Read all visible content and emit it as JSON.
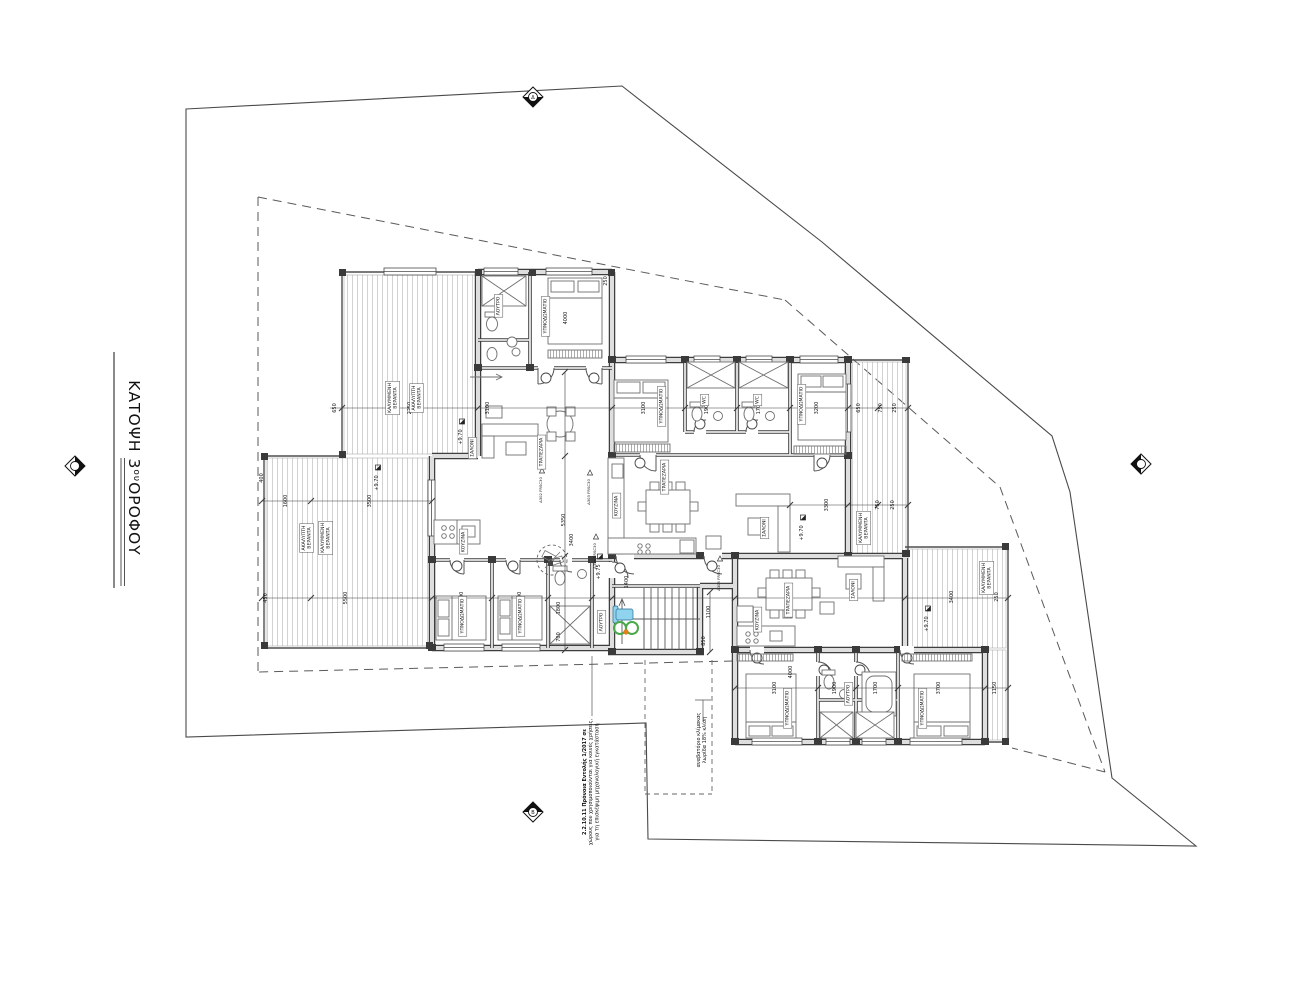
{
  "title": {
    "prefix": "ΚΑΤΟΨΗ 3",
    "superscript": "ου",
    "suffix": "ΟΡΟΦΟΥ"
  },
  "annotations": {
    "room_labels": [
      {
        "lines": [
          "ΥΠΝΟΔΩΜΑΤΙΟ"
        ],
        "x": 545,
        "y": 316
      },
      {
        "lines": [
          "ΛΟΥΤΡΟ"
        ],
        "x": 498,
        "y": 306
      },
      {
        "lines": [
          "ΣΑΛΟΝΙ"
        ],
        "x": 472,
        "y": 448
      },
      {
        "lines": [
          "ΤΡΑΠΕΖΑΡΙΑ"
        ],
        "x": 541,
        "y": 452
      },
      {
        "lines": [
          "ΚΟΥΖΙΝΑ"
        ],
        "x": 463,
        "y": 542
      },
      {
        "lines": [
          "ΥΠΝΟΔΩΜΑΤΙΟ"
        ],
        "x": 462,
        "y": 616
      },
      {
        "lines": [
          "ΥΠΝΟΔΩΜΑΤΙΟ"
        ],
        "x": 520,
        "y": 616
      },
      {
        "lines": [
          "ΛΟΥΤΡΟ"
        ],
        "x": 601,
        "y": 622
      },
      {
        "lines": [
          "ΚΑΛΥΜΜΕΝΗ",
          "ΒΕΡΑΝΤΑ"
        ],
        "x": 392,
        "y": 398
      },
      {
        "lines": [
          "ΑΚΑΛΥΠΤΗ",
          "ΒΕΡΑΝΤΑ"
        ],
        "x": 416,
        "y": 398
      },
      {
        "lines": [
          "ΑΚΑΛΥΠΤΗ",
          "ΒΕΡΑΝΤΑ"
        ],
        "x": 306,
        "y": 538
      },
      {
        "lines": [
          "ΚΑΛΥΜΜΕΝΗ",
          "ΒΕΡΑΝΤΑ"
        ],
        "x": 325,
        "y": 538
      },
      {
        "lines": [
          "ΥΠΝΟΔΩΜΑΤΙΟ"
        ],
        "x": 661,
        "y": 406
      },
      {
        "lines": [
          "WC"
        ],
        "x": 704,
        "y": 400
      },
      {
        "lines": [
          "WC"
        ],
        "x": 757,
        "y": 400
      },
      {
        "lines": [
          "ΥΠΝΟΔΩΜΑΤΙΟ"
        ],
        "x": 801,
        "y": 404
      },
      {
        "lines": [
          "ΚΟΥΖΙΝΑ"
        ],
        "x": 616,
        "y": 506
      },
      {
        "lines": [
          "ΤΡΑΠΕΖΑΡΙΑ"
        ],
        "x": 664,
        "y": 477
      },
      {
        "lines": [
          "ΣΑΛΟΝΙ"
        ],
        "x": 764,
        "y": 528
      },
      {
        "lines": [
          "ΚΑΛΥΜΜΕΝΗ",
          "ΒΕΡΑΝΤΑ"
        ],
        "x": 863,
        "y": 528
      },
      {
        "lines": [
          "ΤΡΑΠΕΖΑΡΙΑ"
        ],
        "x": 788,
        "y": 600
      },
      {
        "lines": [
          "ΣΑΛΟΝΙ"
        ],
        "x": 853,
        "y": 590
      },
      {
        "lines": [
          "ΚΟΥΖΙΝΑ"
        ],
        "x": 757,
        "y": 620
      },
      {
        "lines": [
          "ΥΠΝΟΔΩΜΑΤΙΟ"
        ],
        "x": 787,
        "y": 708
      },
      {
        "lines": [
          "ΛΟΥΤΡΟ"
        ],
        "x": 848,
        "y": 694
      },
      {
        "lines": [
          "ΥΠΝΟΔΩΜΑΤΙΟ"
        ],
        "x": 922,
        "y": 708
      },
      {
        "lines": [
          "ΚΑΛΥΜΜΕΝΗ",
          "ΒΕΡΑΝΤΑ"
        ],
        "x": 986,
        "y": 578
      }
    ],
    "dimensions": [
      {
        "t": "650",
        "x": 336,
        "y": 408
      },
      {
        "t": "2250",
        "x": 411,
        "y": 408
      },
      {
        "t": "3100",
        "x": 489,
        "y": 408
      },
      {
        "t": "3100",
        "x": 645,
        "y": 408
      },
      {
        "t": "1900",
        "x": 708,
        "y": 408
      },
      {
        "t": "1700",
        "x": 760,
        "y": 408
      },
      {
        "t": "3200",
        "x": 818,
        "y": 408
      },
      {
        "t": "650",
        "x": 860,
        "y": 408
      },
      {
        "t": "750",
        "x": 882,
        "y": 408
      },
      {
        "t": "250",
        "x": 896,
        "y": 408
      },
      {
        "t": "250",
        "x": 607,
        "y": 281
      },
      {
        "t": "450",
        "x": 267,
        "y": 598
      },
      {
        "t": "5500",
        "x": 347,
        "y": 598
      },
      {
        "t": "2000",
        "x": 463,
        "y": 598
      },
      {
        "t": "3100",
        "x": 521,
        "y": 598
      },
      {
        "t": "4200",
        "x": 791,
        "y": 597
      },
      {
        "t": "3400",
        "x": 953,
        "y": 597
      },
      {
        "t": "250",
        "x": 998,
        "y": 597
      },
      {
        "t": "3100",
        "x": 776,
        "y": 688
      },
      {
        "t": "4000",
        "x": 792,
        "y": 672
      },
      {
        "t": "1900",
        "x": 836,
        "y": 688
      },
      {
        "t": "1700",
        "x": 877,
        "y": 688
      },
      {
        "t": "3700",
        "x": 940,
        "y": 688
      },
      {
        "t": "1150",
        "x": 996,
        "y": 688
      },
      {
        "t": "1600",
        "x": 287,
        "y": 501
      },
      {
        "t": "3500",
        "x": 371,
        "y": 501
      },
      {
        "t": "3300",
        "x": 828,
        "y": 505
      },
      {
        "t": "750",
        "x": 879,
        "y": 505
      },
      {
        "t": "250",
        "x": 894,
        "y": 505
      },
      {
        "t": "4000",
        "x": 567,
        "y": 318
      },
      {
        "t": "5350",
        "x": 565,
        "y": 520
      },
      {
        "t": "3400",
        "x": 573,
        "y": 540
      },
      {
        "t": "1800",
        "x": 560,
        "y": 608
      },
      {
        "t": "700",
        "x": 560,
        "y": 637
      },
      {
        "t": "1400",
        "x": 628,
        "y": 582
      },
      {
        "t": "1100",
        "x": 710,
        "y": 612
      },
      {
        "t": "850",
        "x": 705,
        "y": 641
      },
      {
        "t": "400",
        "x": 263,
        "y": 478
      }
    ],
    "levels": [
      {
        "t": "+9.70",
        "x": 462,
        "y": 437
      },
      {
        "t": "+9.70",
        "x": 378,
        "y": 483
      },
      {
        "t": "+9.70",
        "x": 803,
        "y": 533
      },
      {
        "t": "+9.70",
        "x": 928,
        "y": 624
      },
      {
        "t": "+9.75",
        "x": 600,
        "y": 572
      }
    ],
    "door_tags": [
      {
        "t": "Δ302 FRSC30",
        "x": 542,
        "y": 490
      },
      {
        "t": "Δ303 FRSC30",
        "x": 590,
        "y": 492
      },
      {
        "t": "Δ304 FRSC30",
        "x": 596,
        "y": 556
      },
      {
        "t": "Δ305 FRSC30",
        "x": 720,
        "y": 578
      }
    ],
    "notes": [
      {
        "x": 586,
        "y": 782,
        "bold_first": true,
        "lines": [
          "2.2.10.11 Πρόνοια Εντολής 1/2017 σε",
          "χώρους που χρησιμοποιούνται για κοινές χρήσεις,",
          "για τη επισκέψιμη μηχανολογική εγκατάσταση"
        ]
      },
      {
        "x": 700,
        "y": 740,
        "bold_first": false,
        "lines": [
          "αναβατόριο κλίμακας",
          "λωρίδα 18% κλίση"
        ]
      }
    ],
    "markers": [
      {
        "letter": "Δ",
        "x": 533,
        "y": 97,
        "fill": "bottom"
      },
      {
        "letter": "",
        "x": 75,
        "y": 466,
        "fill": "right"
      },
      {
        "letter": "",
        "x": 1141,
        "y": 464,
        "fill": "left"
      },
      {
        "letter": "Β",
        "x": 533,
        "y": 812,
        "fill": "top"
      }
    ]
  },
  "colors": {
    "line": "#2f2f2f",
    "wall_fill": "#e0e0e0",
    "hatch": "#c6c6c6",
    "lift_green": "#4aa94a",
    "lift_blue": "#8fd3ee",
    "lift_orange": "#e2801a"
  }
}
